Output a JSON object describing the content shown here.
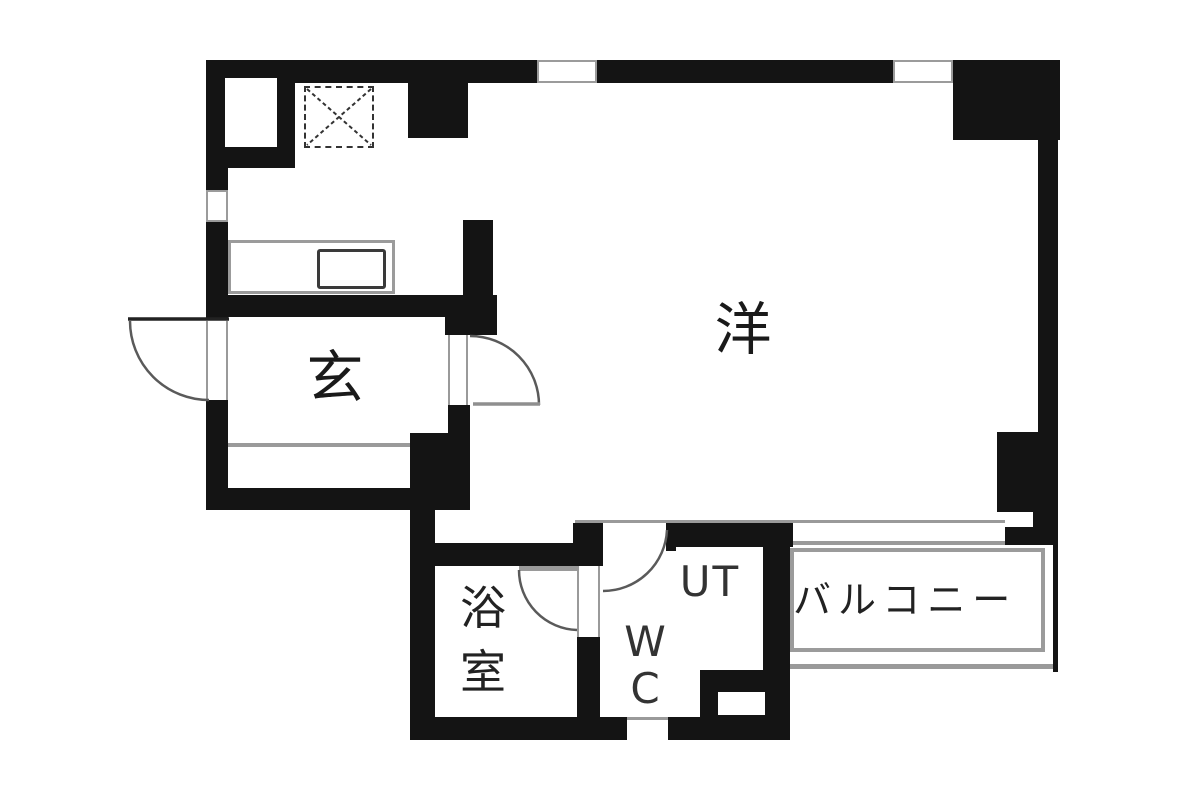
{
  "document": {
    "type": "apartment-floor-plan"
  },
  "rooms": {
    "western_room": {
      "label": "洋"
    },
    "entrance": {
      "label": "玄"
    },
    "bathroom": {
      "label": "浴室"
    },
    "toilet": {
      "label": "WC"
    },
    "utility": {
      "label": "UT"
    },
    "balcony": {
      "label": "バルコニー"
    }
  },
  "symbols": {
    "range_space": "dashed-box-with-x",
    "kitchen_counter": "gray-outline-rectangle",
    "kitchen_sink": "dark-outline-rounded-rectangle",
    "doors": [
      "entrance-swing-door",
      "living-room-swing-door",
      "bathroom-swing-door",
      "toilet-swing-door"
    ],
    "windows": [
      "top-wall-window-left",
      "top-wall-window-right",
      "left-wall-window",
      "bottom-wall-vent"
    ]
  },
  "colors": {
    "wall": "#141414",
    "thin_line": "#9a9a9a",
    "label_text": "#222222",
    "background": "#ffffff"
  }
}
